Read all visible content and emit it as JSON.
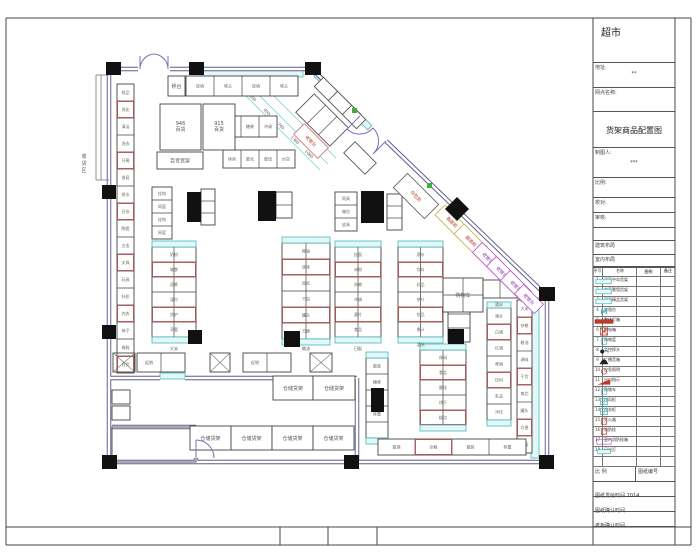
{
  "title_block": {
    "store_title": "超市",
    "address_label": "地址:",
    "address_value": "**",
    "site_label": "网点名称:",
    "drawing_title": "货架商品配置图",
    "drafter_label": "制图人:",
    "drafter_value": "***",
    "scale_label": "比例:",
    "check_label": "校对:",
    "audit_label": "审核:",
    "arch_label": "建筑布局",
    "interior_label": "室内布局",
    "legend_header": [
      "序号",
      "名称",
      "图例",
      "备注"
    ],
    "legend_rows": [
      {
        "no": "1",
        "name": "双面中岛货架",
        "icon": "cyanrect"
      },
      {
        "no": "2",
        "name": "单面靠墙货架",
        "icon": "cyanrect"
      },
      {
        "no": "3",
        "name": "双面精品货架",
        "icon": "cyanrect"
      },
      {
        "no": "4",
        "name": "收银台",
        "icon": "m"
      },
      {
        "no": "5",
        "name": "整体灯箱",
        "icon": "redbar"
      },
      {
        "no": "6",
        "name": "配电箱",
        "icon": "redx"
      },
      {
        "no": "7",
        "name": "购物篮",
        "icon": "cyansm"
      },
      {
        "no": "8",
        "name": "监控探头",
        "icon": "cam"
      },
      {
        "no": "9",
        "name": "广播音箱",
        "icon": "speaker"
      },
      {
        "no": "10",
        "name": "应急照明",
        "icon": "redcirc"
      },
      {
        "no": "11",
        "name": "出口指示",
        "icon": "redflag"
      },
      {
        "no": "12",
        "name": "购物车",
        "icon": "cyansm"
      },
      {
        "no": "13",
        "name": "冷风柜",
        "icon": "cyanpat"
      },
      {
        "no": "14",
        "name": "冷冻柜",
        "icon": "cyanpat"
      },
      {
        "no": "15",
        "name": "灭火器",
        "icon": "redsm"
      },
      {
        "no": "16",
        "name": "消防栓",
        "icon": "redsm"
      },
      {
        "no": "17",
        "name": "室内消防栓箱",
        "icon": "magbox"
      },
      {
        "no": "18",
        "name": "日光灯",
        "icon": "cyanbar"
      },
      {
        "no": "",
        "name": "",
        "icon": "blank"
      }
    ],
    "scale_row_left": "比  例",
    "scale_row_right": "图纸编号",
    "time_rows": [
      {
        "label": "图纸发给时间",
        "value": "2014"
      },
      {
        "label": "图纸确认时间",
        "value": ""
      },
      {
        "label": "老板确认时间",
        "value": ""
      }
    ]
  },
  "plan": {
    "wall_segments": [
      [
        109,
        69,
        138,
        69
      ],
      [
        170,
        69,
        312,
        69
      ],
      [
        312,
        69,
        360,
        116
      ],
      [
        386,
        141,
        547,
        296
      ],
      [
        547,
        296,
        547,
        462
      ],
      [
        109,
        462,
        547,
        462
      ],
      [
        109,
        69,
        109,
        462
      ],
      [
        109,
        378,
        160,
        378
      ],
      [
        185,
        378,
        357,
        378
      ],
      [
        357,
        378,
        357,
        462
      ],
      [
        112,
        427,
        196,
        427
      ],
      [
        196,
        427,
        196,
        440
      ],
      [
        196,
        458,
        196,
        462
      ]
    ],
    "annex_lines": [
      [
        96,
        75,
        96,
        180
      ],
      [
        101,
        75,
        101,
        180
      ],
      [
        96,
        75,
        109,
        75
      ],
      [
        96,
        180,
        109,
        180
      ]
    ],
    "cyan_bands": [
      {
        "x": 201,
        "y": 70,
        "w": 102,
        "h": 7
      },
      {
        "x": 531,
        "y": 298,
        "w": 8,
        "h": 160
      },
      {
        "x": 160,
        "y": 373,
        "w": 25,
        "h": 6
      }
    ],
    "diag_band": {
      "x": 316,
      "y": 71,
      "w": 76,
      "h": 6,
      "cx": 316,
      "cy": 74
    },
    "columns": [
      [
        106,
        62,
        15,
        13
      ],
      [
        189,
        62,
        15,
        13
      ],
      [
        305,
        62,
        16,
        13
      ],
      [
        102,
        185,
        14,
        14
      ],
      [
        102,
        325,
        14,
        14
      ],
      [
        102,
        455,
        15,
        14
      ],
      [
        344,
        455,
        15,
        14
      ],
      [
        539,
        455,
        15,
        14
      ],
      [
        539,
        287,
        16,
        14
      ]
    ],
    "diamond": {
      "cx": 457,
      "cy": 209,
      "s": 17
    },
    "pillars": [
      [
        187,
        192,
        14,
        30
      ],
      [
        258,
        191,
        18,
        30
      ],
      [
        361,
        191,
        23,
        32
      ],
      [
        188,
        330,
        14,
        14
      ],
      [
        284,
        331,
        16,
        16
      ],
      [
        448,
        329,
        16,
        15
      ],
      [
        371,
        388,
        13,
        24
      ]
    ],
    "green_marks": [
      [
        352,
        108
      ],
      [
        427,
        183
      ]
    ],
    "door_paths": [
      "M140,69 A15,15 0 0 1 154,54 M140,69 L140,56",
      "M168,69 A15,15 0 0 0 154,54 M168,69 L168,56",
      "M360,116 L347,129 A18,18 0 0 0 373,128",
      "M386,141 L373,154 A18,18 0 0 0 373,128",
      "M196,440 A18,18 0 0 1 214,458",
      "M196,440 L196,458"
    ],
    "dims": {
      "lines": [
        [
          238,
          88,
          320,
          170
        ],
        [
          246,
          82,
          328,
          164
        ],
        [
          254,
          76,
          336,
          158
        ]
      ],
      "labels": [
        {
          "x": 252,
          "y": 99,
          "t": "600"
        },
        {
          "x": 266,
          "y": 113,
          "t": "950"
        },
        {
          "x": 280,
          "y": 127,
          "t": "760"
        },
        {
          "x": 294,
          "y": 141,
          "t": "1360"
        },
        {
          "x": 308,
          "y": 155,
          "t": "1060"
        }
      ]
    },
    "strips": [
      {
        "x": 117,
        "y": 84,
        "dir": "v",
        "n": 17,
        "cw": 17,
        "ch": 17,
        "mix": true,
        "labels": [
          "纸品",
          "洗化",
          "清洁",
          "洗衣",
          "牙膏",
          "香皂",
          "纸巾",
          "日杂",
          "陶瓷",
          "五金",
          "文具",
          "玩具",
          "针织",
          "内衣",
          "袜子",
          "拖鞋",
          "百货"
        ]
      },
      {
        "x": 186,
        "y": 76,
        "dir": "h",
        "n": 4,
        "cw": 28,
        "ch": 20,
        "labels": [
          "促销",
          "堆头",
          "促销",
          "堆头"
        ]
      },
      {
        "x": 223,
        "y": 116,
        "dir": "h",
        "n": 3,
        "cw": 18,
        "ch": 21,
        "labels": [
          "饼干",
          "糖果",
          "冲调"
        ]
      },
      {
        "x": 223,
        "y": 150,
        "dir": "h",
        "n": 4,
        "cw": 18,
        "ch": 18,
        "labels": [
          "休闲",
          "膨化",
          "蜜饯",
          "炒货"
        ]
      },
      {
        "x": 152,
        "y": 187,
        "dir": "v",
        "n": 4,
        "cw": 20,
        "ch": 13,
        "labels": [
          "挂钩",
          "网篮",
          "挂钩",
          "网篮"
        ]
      },
      {
        "x": 201,
        "y": 189,
        "dir": "v",
        "n": 3,
        "cw": 14,
        "ch": 12,
        "labels": [
          "",
          ""
        ]
      },
      {
        "x": 276,
        "y": 192,
        "dir": "v",
        "n": 2,
        "cw": 16,
        "ch": 13,
        "labels": [
          "",
          ""
        ]
      },
      {
        "x": 335,
        "y": 192,
        "dir": "v",
        "n": 3,
        "cw": 22,
        "ch": 13,
        "labels": [
          "雨具",
          "箱包",
          "皮具"
        ]
      },
      {
        "x": 387,
        "y": 194,
        "dir": "v",
        "n": 3,
        "cw": 15,
        "ch": 12,
        "labels": [
          "",
          ""
        ]
      },
      {
        "x": 152,
        "y": 247,
        "dir": "v",
        "n": 6,
        "cw": 44,
        "ch": 15,
        "cols": 2,
        "mix": true,
        "cap": true,
        "labels": [
          "奶粉",
          "辅食",
          "尿裤",
          "湿巾",
          "洗护",
          "孕婴"
        ]
      },
      {
        "x": 282,
        "y": 243,
        "dir": "v",
        "n": 6,
        "cw": 48,
        "ch": 16,
        "cols": 2,
        "mix": true,
        "cap": true,
        "labels": [
          "粮油",
          "调味",
          "南北",
          "干货",
          "罐头",
          "方便"
        ]
      },
      {
        "x": 335,
        "y": 247,
        "dir": "v",
        "n": 6,
        "cw": 46,
        "ch": 15,
        "cols": 2,
        "mix": true,
        "cap": true,
        "labels": [
          "挂面",
          "米粉",
          "杂粮",
          "冲调",
          "麦片",
          "食品"
        ]
      },
      {
        "x": 398,
        "y": 247,
        "dir": "v",
        "n": 6,
        "cw": 45,
        "ch": 15,
        "cols": 2,
        "mix": true,
        "cap": true,
        "labels": [
          "酒水",
          "饮料",
          "乳品",
          "茶叶",
          "饮品",
          "果汁"
        ]
      },
      {
        "x": 448,
        "y": 300,
        "dir": "v",
        "n": 3,
        "cw": 22,
        "ch": 14,
        "labels": [
          "饮料",
          ""
        ]
      },
      {
        "x": 366,
        "y": 358,
        "dir": "v",
        "n": 5,
        "cw": 22,
        "ch": 16,
        "cap": true,
        "labels": [
          "散装",
          "糖果",
          "炒货",
          "称重"
        ]
      },
      {
        "x": 420,
        "y": 350,
        "dir": "v",
        "n": 5,
        "cw": 46,
        "ch": 15,
        "cols": 2,
        "mix": true,
        "cap": true,
        "labels": [
          "休闲",
          "食品",
          "膨化",
          "饼干",
          "糕点"
        ]
      },
      {
        "x": 487,
        "y": 308,
        "dir": "v",
        "n": 7,
        "cw": 24,
        "ch": 16,
        "mix": true,
        "cap": true,
        "labels": [
          "酒水",
          "白酒",
          "红酒",
          "啤酒",
          "饮料",
          "乳品",
          "冲饮"
        ]
      },
      {
        "x": 517,
        "y": 300,
        "dir": "v",
        "n": 9,
        "cw": 15,
        "ch": 17,
        "mix": true,
        "labels": [
          "大米",
          "杂粮",
          "粮油",
          "调味",
          "干货",
          "南北",
          "罐头",
          "方便",
          "挂面"
        ]
      },
      {
        "x": 378,
        "y": 439,
        "dir": "h",
        "n": 4,
        "cw": 37,
        "ch": 16,
        "mix": true,
        "labels": [
          "散酒",
          "杂粮",
          "散装",
          "称重"
        ]
      },
      {
        "x": 137,
        "y": 353,
        "dir": "h",
        "n": 2,
        "cw": 24,
        "ch": 19,
        "labels": [
          "促销",
          ""
        ]
      },
      {
        "x": 243,
        "y": 353,
        "dir": "h",
        "n": 2,
        "cw": 24,
        "ch": 19,
        "labels": [
          "促销",
          ""
        ]
      }
    ],
    "xboxes": [
      [
        113,
        353,
        22,
        19
      ],
      [
        310,
        353,
        22,
        19
      ],
      [
        210,
        353,
        20,
        19
      ]
    ],
    "boxes": [
      {
        "x": 168,
        "y": 76,
        "w": 17,
        "h": 20,
        "label": "称台"
      },
      {
        "x": 160,
        "y": 104,
        "w": 41,
        "h": 46,
        "label": "946\n百货"
      },
      {
        "x": 203,
        "y": 104,
        "w": 32,
        "h": 46,
        "label": "915\n百货"
      },
      {
        "x": 157,
        "y": 152,
        "w": 46,
        "h": 17,
        "label": "百货货架"
      },
      {
        "x": 443,
        "y": 278,
        "w": 40,
        "h": 34,
        "label": "购物车",
        "grid": "2x2"
      },
      {
        "x": 483,
        "y": 280,
        "w": 34,
        "h": 18,
        "label": "",
        "grid": "2x1"
      },
      {
        "x": 273,
        "y": 376,
        "w": 40,
        "h": 24,
        "label": "仓储货架"
      },
      {
        "x": 313,
        "y": 376,
        "w": 42,
        "h": 24,
        "label": "仓储货架"
      },
      {
        "x": 190,
        "y": 426,
        "w": 41,
        "h": 24,
        "label": "仓储货架"
      },
      {
        "x": 231,
        "y": 426,
        "w": 41,
        "h": 24,
        "label": "仓储货架"
      },
      {
        "x": 272,
        "y": 426,
        "w": 41,
        "h": 24,
        "label": "仓储货架"
      },
      {
        "x": 313,
        "y": 426,
        "w": 41,
        "h": 24,
        "label": "仓储货架"
      },
      {
        "x": 112,
        "y": 390,
        "w": 18,
        "h": 14,
        "label": ""
      },
      {
        "x": 112,
        "y": 406,
        "w": 18,
        "h": 14,
        "label": ""
      }
    ],
    "rot_boxes": [
      {
        "cx": 326,
        "cy": 89,
        "w": 20,
        "h": 13,
        "stroke": "#555",
        "label": "",
        "lc": ""
      },
      {
        "cx": 340,
        "cy": 103,
        "w": 20,
        "h": 13,
        "stroke": "#555",
        "label": "",
        "lc": ""
      },
      {
        "cx": 354,
        "cy": 117,
        "w": 20,
        "h": 13,
        "stroke": "#555",
        "label": "",
        "lc": ""
      },
      {
        "cx": 322,
        "cy": 120,
        "w": 48,
        "h": 26,
        "stroke": "#555",
        "label": "",
        "lc": "",
        "grid": 3
      },
      {
        "cx": 311,
        "cy": 141,
        "w": 34,
        "h": 15,
        "stroke": "#cc7777",
        "label": "收银台",
        "lc": "#c0392b"
      },
      {
        "cx": 360,
        "cy": 158,
        "w": 30,
        "h": 16,
        "stroke": "#555",
        "label": "",
        "lc": ""
      },
      {
        "cx": 416,
        "cy": 196,
        "w": 44,
        "h": 20,
        "stroke": "#666",
        "label": "存包处",
        "lc": "#c0392b"
      },
      {
        "cx": 452,
        "cy": 222,
        "w": 34,
        "h": 14,
        "stroke": "#c9b458",
        "label": "香烟柜",
        "lc": "#c0392b"
      },
      {
        "cx": 471,
        "cy": 241,
        "w": 34,
        "h": 14,
        "stroke": "#c9b458",
        "label": "烟酒柜",
        "lc": "#c0392b"
      },
      {
        "cx": 488,
        "cy": 258,
        "w": 30,
        "h": 14,
        "stroke": "#c060c0",
        "label": "收银台",
        "lc": "#8833bb"
      },
      {
        "cx": 502,
        "cy": 272,
        "w": 30,
        "h": 14,
        "stroke": "#c060c0",
        "label": "收银台",
        "lc": "#8833bb"
      },
      {
        "cx": 516,
        "cy": 286,
        "w": 30,
        "h": 14,
        "stroke": "#c060c0",
        "label": "收银台",
        "lc": "#8833bb"
      },
      {
        "cx": 529,
        "cy": 299,
        "w": 28,
        "h": 13,
        "stroke": "#c060c0",
        "label": "收银台",
        "lc": "#8833bb"
      }
    ],
    "texts": [
      {
        "x": 84,
        "y": 158,
        "t": "收货区",
        "vert": true,
        "fs": 5,
        "c": "#555"
      },
      {
        "x": 174,
        "y": 350,
        "t": "大米",
        "fs": 4,
        "c": "#555"
      },
      {
        "x": 306,
        "y": 350,
        "t": "粮油",
        "fs": 4,
        "c": "#555"
      },
      {
        "x": 358,
        "y": 350,
        "t": "日配",
        "fs": 4,
        "c": "#555"
      },
      {
        "x": 421,
        "y": 346,
        "t": "酒水",
        "fs": 4,
        "c": "#555"
      },
      {
        "x": 499,
        "y": 306,
        "t": "酒水",
        "fs": 4,
        "c": "#555"
      }
    ],
    "room": {
      "x": 112,
      "y": 427,
      "w": 84,
      "h": 35
    }
  },
  "sheet": {
    "frame": {
      "top_y": 18,
      "bottom_y": 545,
      "inner_bottom_y": 527,
      "left_x": 6,
      "right_x": 691,
      "titleblock_left": 593,
      "titleblock_right": 675,
      "strip_dividers": [
        280,
        328,
        377,
        593,
        675
      ]
    }
  }
}
